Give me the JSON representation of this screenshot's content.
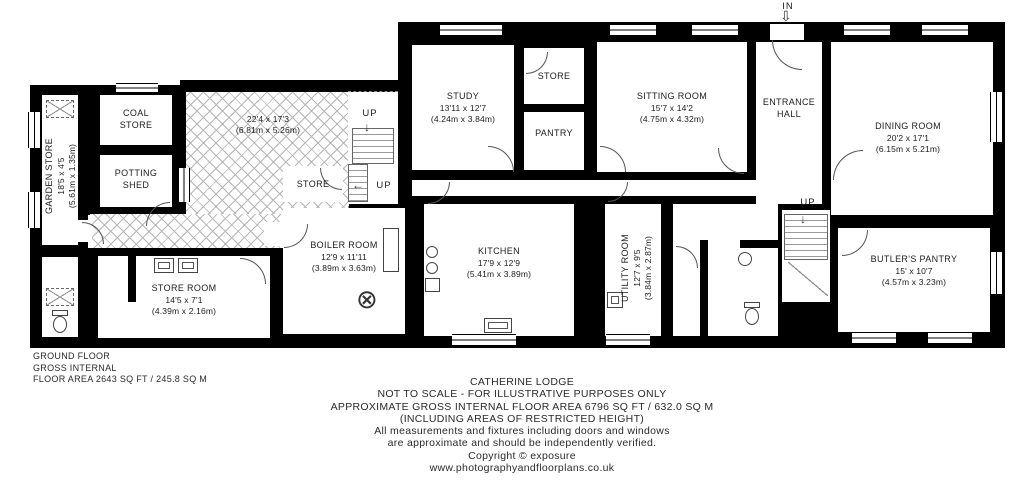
{
  "plan": {
    "in_label": "IN",
    "up_label": "UP"
  },
  "rooms": {
    "garden_store": {
      "name": "GARDEN STORE",
      "dims": "18'5 x 4'5",
      "metric": "(5.61m x 1.35m)"
    },
    "coal_store": {
      "line1": "COAL",
      "line2": "STORE"
    },
    "potting_shed": {
      "line1": "POTTING",
      "line2": "SHED"
    },
    "courtyard": {
      "dims": "22'4 x 17'3",
      "metric": "(6.81m x 5.26m)"
    },
    "store_small": {
      "name": "STORE"
    },
    "boiler_room": {
      "name": "BOILER ROOM",
      "dims": "12'9 x 11'11",
      "metric": "(3.89m x 3.63m)"
    },
    "store_room": {
      "name": "STORE ROOM",
      "dims": "14'5 x 7'1",
      "metric": "(4.39m x 2.16m)"
    },
    "study": {
      "name": "STUDY",
      "dims": "13'11 x 12'7",
      "metric": "(4.24m x 3.84m)"
    },
    "store_top": {
      "name": "STORE"
    },
    "pantry": {
      "name": "PANTRY"
    },
    "kitchen": {
      "name": "KITCHEN",
      "dims": "17'9 x 12'9",
      "metric": "(5.41m x 3.89m)"
    },
    "sitting_room": {
      "name": "SITTING ROOM",
      "dims": "15'7 x 14'2",
      "metric": "(4.75m x 4.32m)"
    },
    "entrance_hall": {
      "line1": "ENTRANCE",
      "line2": "HALL"
    },
    "dining_room": {
      "name": "DINING ROOM",
      "dims": "20'2 x 17'1",
      "metric": "(6.15m x 5.21m)"
    },
    "utility_room": {
      "name": "UTILITY ROOM",
      "dims": "12'7 x 9'5",
      "metric": "(3.84m x 2.87m)"
    },
    "butlers_pantry": {
      "name": "BUTLER'S PANTRY",
      "dims": "15' x 10'7",
      "metric": "(4.57m x 3.23m)"
    }
  },
  "floor_summary": {
    "line1": "GROUND FLOOR",
    "line2": "GROSS INTERNAL",
    "line3": "FLOOR AREA 2643 SQ FT / 245.8 SQ M"
  },
  "footer": {
    "title": "CATHERINE LODGE",
    "line2": "NOT TO SCALE - FOR ILLUSTRATIVE PURPOSES ONLY",
    "line3": "APPROXIMATE GROSS INTERNAL FLOOR AREA 6796 SQ FT / 632.0 SQ M",
    "line4": "(INCLUDING AREAS OF RESTRICTED HEIGHT)",
    "line5": "All measurements and fixtures including doors and windows",
    "line6": "are approximate and should be independently verified.",
    "line7": "Copyright © exposure",
    "line8": "www.photographyandfloorplans.co.uk"
  },
  "colors": {
    "wall": "#000000",
    "background": "#ffffff",
    "hatch_line": "#b5b5b5",
    "text": "#1c1c1c"
  }
}
